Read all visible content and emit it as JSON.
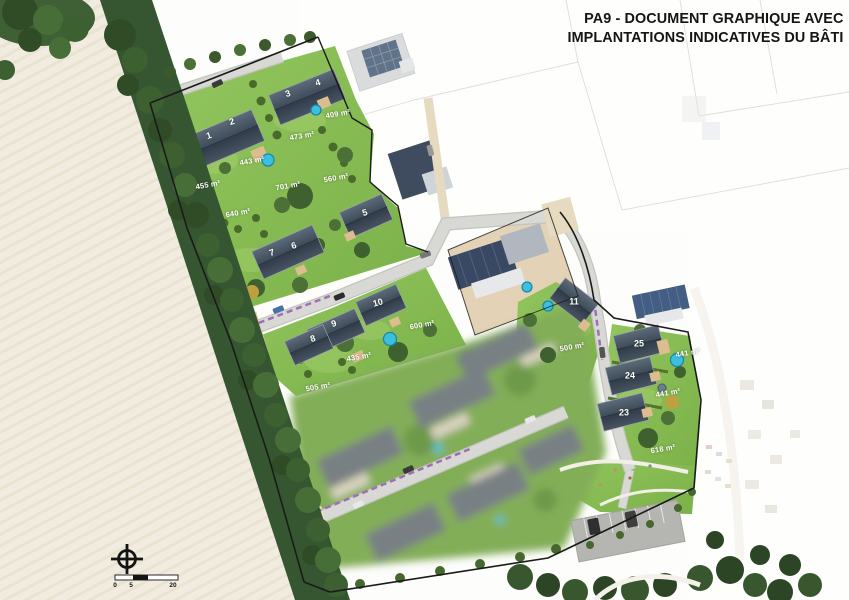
{
  "title": {
    "line1": "PA9 - DOCUMENT GRAPHIQUE AVEC",
    "line2": "IMPLANTATIONS INDICATIVES DU BÂTI"
  },
  "lots": [
    {
      "number": "1",
      "area": "455 m²"
    },
    {
      "number": "2",
      "area": "443 m²"
    },
    {
      "number": "3",
      "area": "473 m²"
    },
    {
      "number": "4",
      "area": "409 m²"
    },
    {
      "number": "5",
      "area": "560 m²"
    },
    {
      "number": "6",
      "area": "701 m²"
    },
    {
      "number": "7",
      "area": "640 m²"
    },
    {
      "number": "8",
      "area": "505 m²"
    },
    {
      "number": "9",
      "area": "435 m²"
    },
    {
      "number": "10",
      "area": "600 m²"
    },
    {
      "number": "11",
      "area": "500 m²"
    },
    {
      "number": "23",
      "area": "618 m²"
    },
    {
      "number": "24",
      "area": "441 m²"
    },
    {
      "number": "25",
      "area": "441 m²"
    }
  ],
  "scale_bar": {
    "ticks": [
      "0",
      "5",
      "20"
    ]
  },
  "colors": {
    "lawn": "#86bb51",
    "roof": "#3f4c5a",
    "road": "#d6d6d2",
    "boundary": "#1a1a1a",
    "pool": "#3cc0de"
  }
}
